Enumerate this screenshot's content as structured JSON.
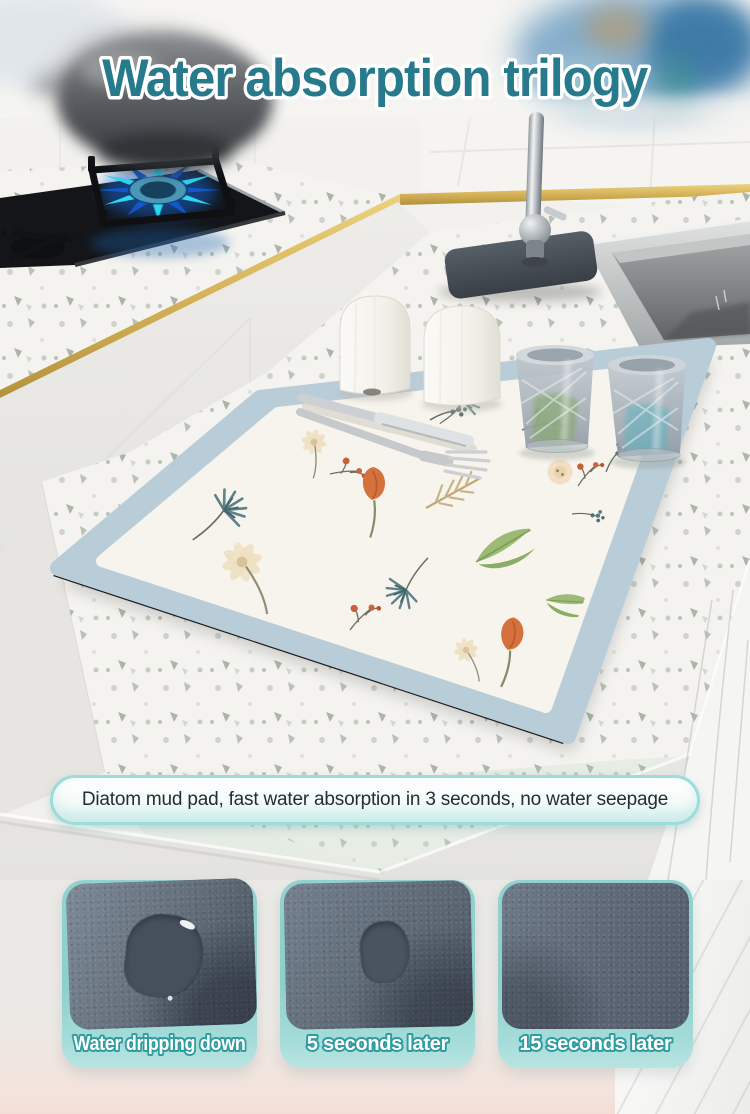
{
  "title": "Water absorption trilogy",
  "callout": {
    "text": "Diatom mud pad, fast water absorption in 3 seconds, no water seepage"
  },
  "steps": [
    {
      "label": "Water dripping down"
    },
    {
      "label": "5 seconds later"
    },
    {
      "label": "15 seconds later"
    }
  ],
  "scene": {
    "objects": [
      "gas-stove with blue flame",
      "pot",
      "gold trim",
      "chrome faucet",
      "steel sink",
      "terrazzo countertop",
      "floral drying mat",
      "two white shakers",
      "two crystal glasses",
      "knife and fork"
    ]
  },
  "colors": {
    "title_text": "#27798c",
    "title_outline": "#ffffff",
    "callout_border": "#9ddcd9",
    "card_teal": "#8ccfcb",
    "label_text": "#ffffff",
    "label_outline": "#2f9da0",
    "gold_trim": "#d8b75e",
    "mat_border": "#b9cdd9",
    "mat_ground": "#f6f4ec",
    "flame_cyan": "#2bd9f0",
    "flame_blue": "#1258cc",
    "wet_spot": "#45505c"
  }
}
